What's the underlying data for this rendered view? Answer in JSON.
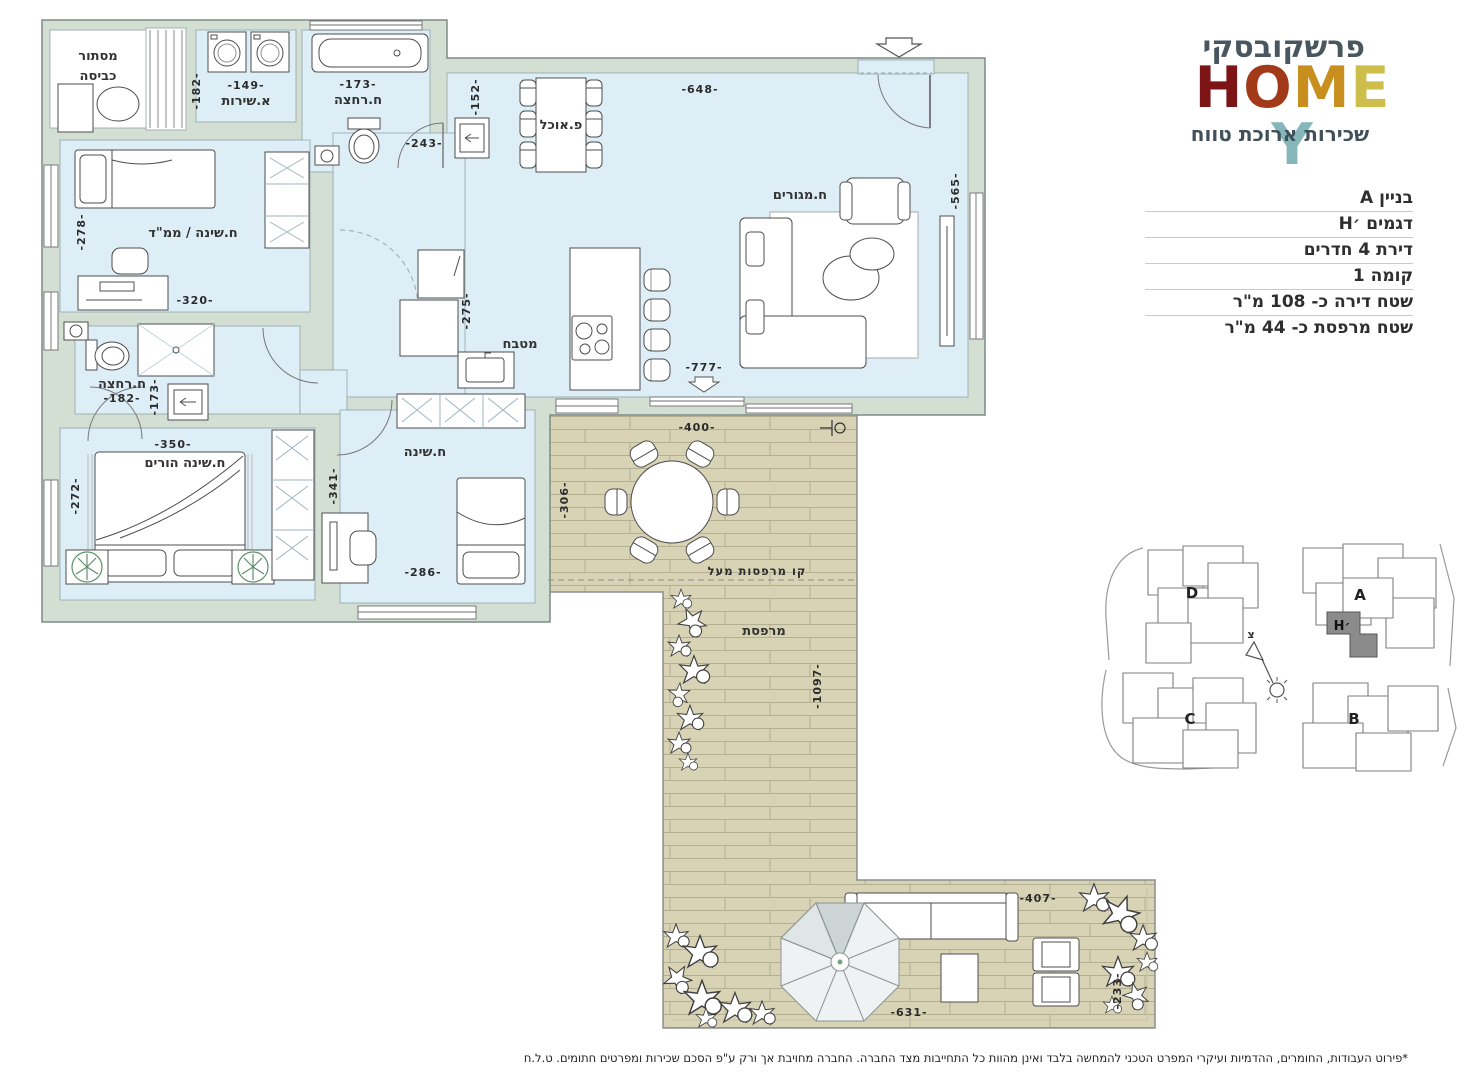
{
  "brand": {
    "name": "פרשקובסקי",
    "logo_letters": [
      {
        "ch": "H",
        "color": "#7d1517"
      },
      {
        "ch": "O",
        "color": "#a23a1a"
      },
      {
        "ch": "M",
        "color": "#c88e1e"
      },
      {
        "ch": "E",
        "color": "#cdbd4a"
      },
      {
        "ch": "Y",
        "color": "#85b6ba"
      }
    ],
    "tagline": "שכירות ארוכת טווח"
  },
  "details": {
    "rows": [
      {
        "text": "בניין A"
      },
      {
        "text": "דגמים ׳H"
      },
      {
        "text": "דירת 4 חדרים"
      },
      {
        "text": "קומה 1"
      },
      {
        "text": "שטח דירה כ- 108 מ\"ר"
      },
      {
        "text": "שטח מרפסת כ- 44 מ\"ר"
      }
    ]
  },
  "plan": {
    "laundry_line1": "מסתור",
    "laundry_line2": "כביסה",
    "service_wc": "א.שירות",
    "bath_top": "ח.רחצה",
    "dining": "פ.אוכל",
    "living": "ח.מגורים",
    "saferoom": "ח.שינה / ממ\"ד",
    "kitchen": "מטבח",
    "bath_master": "ח.רחצה",
    "master_bedroom": "ח.שינה הורים",
    "bedroom": "ח.שינה",
    "balcony_line_above": "קו מרפסות מעל",
    "balcony": "מרפסת",
    "dims": {
      "wc_w": "-149-",
      "wc_h": "-182-",
      "bath_top_w": "-173-",
      "hall_w": "-243-",
      "dining_h": "-152-",
      "living_w": "-648-",
      "living_h": "-565-",
      "saferoom_h": "-278-",
      "saferoom_w": "-320-",
      "kitchen_h": "-275-",
      "bath2_w": "-182-",
      "bath2_h": "-173-",
      "master_w": "-350-",
      "master_h": "-272-",
      "bedroom_h": "-341-",
      "bedroom_w": "-286-",
      "terrace_door_w": "-777-",
      "deck_w": "-400-",
      "deck_h": "-306-",
      "balcony_len": "-1097-",
      "patio_w": "-407-",
      "patio_bottom_w": "-631-",
      "patio_h": "-233-"
    }
  },
  "site": {
    "building_a": "A",
    "building_b": "B",
    "building_c": "C",
    "building_d": "D",
    "unit": "H׳",
    "north_letter": "צ"
  },
  "footer": {
    "disclaimer": "*פירוט העבודות, החומרים, ההדמיות ועיקרי המפרט הטכני להמחשה בלבד ואינן מהוות כל התחייבות מצד החברה. החברה מחויבת אך ורק ע\"פ הסכם שכירות ומפרטים חתומים. ט.ל.ח"
  },
  "colors": {
    "room_fill": "#ddeef7",
    "wall_fill": "#d3dfd2",
    "deck_fill": "#d9d3b6",
    "unit_highlight": "#8b8b8b",
    "brand_text": "#47565f"
  }
}
